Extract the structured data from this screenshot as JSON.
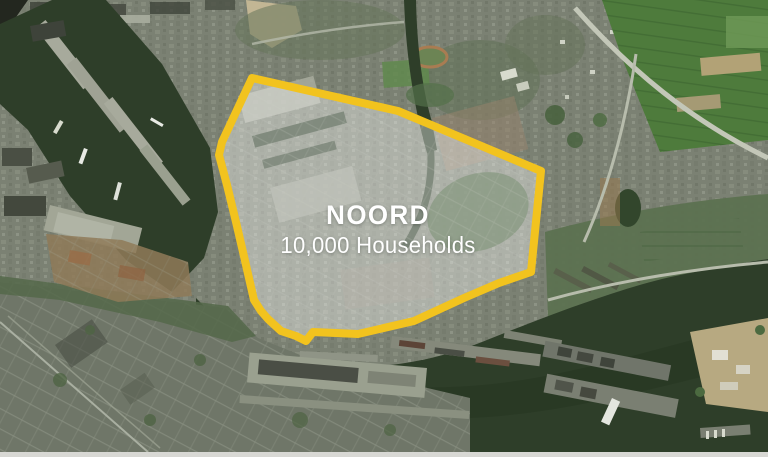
{
  "district": {
    "name": "NOORD",
    "households": "10,000 Households"
  },
  "colors": {
    "outline": "#F2C31E",
    "overlay": "rgba(255,255,255,0.38)",
    "water": "#2E3E29",
    "land": "#7B8173",
    "fields": "#4E7B3C",
    "label": "#FFFFFF"
  }
}
